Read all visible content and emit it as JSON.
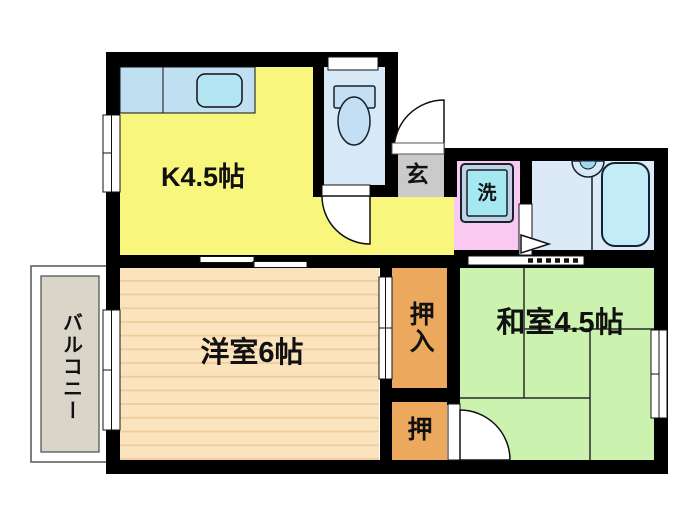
{
  "labels": {
    "kitchen": "K4.5帖",
    "western_room": "洋室6帖",
    "japanese_room": "和室4.5帖",
    "closet_large": "押入",
    "closet_small": "押",
    "entrance": "玄",
    "laundry": "洗",
    "balcony": "バルコニー"
  },
  "palette": {
    "wall": "#000000",
    "kitchen": "#f8f67d",
    "counter": "#c0e0f2",
    "sink": "#b2e4f2",
    "toilet_floor": "#d7e8f7",
    "fixture": "#c4dff4",
    "entrance_floor": "#cacaca",
    "laundry_floor": "#f9c9f1",
    "washer": "#a5e8f2",
    "washer_frame": "#c2d2e2",
    "bath_floor": "#dce9f7",
    "bathtub": "#c3ecf8",
    "western_floor": "#fbe3bd",
    "western_stripe": "#eecb9b",
    "closet": "#eca95e",
    "japanese_floor": "#cbf3af",
    "balcony_floor": "#d9d5c9"
  }
}
